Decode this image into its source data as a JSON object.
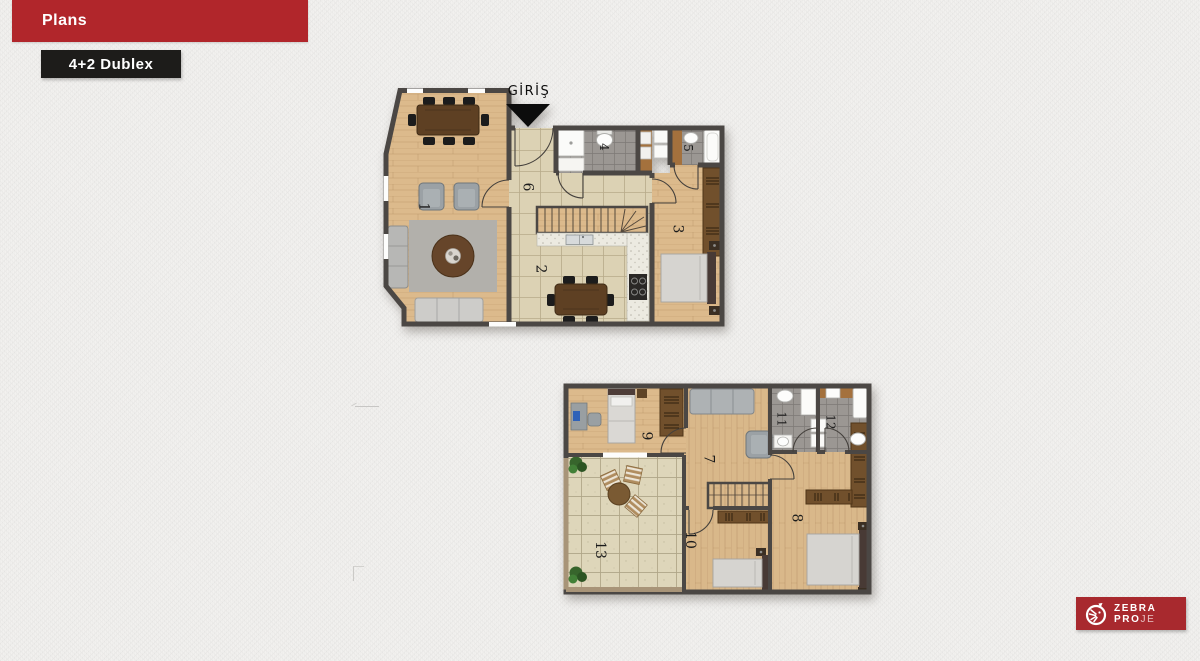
{
  "header": {
    "title": "Plans",
    "bar_color": "#b1262b"
  },
  "badge": {
    "label": "4+2 Dublex",
    "bg_color": "#1d1c1a"
  },
  "plans": {
    "upper": {
      "entrance_label": "GİRİŞ",
      "rooms": [
        {
          "number": "1"
        },
        {
          "number": "2"
        },
        {
          "number": "3"
        },
        {
          "number": "4"
        },
        {
          "number": "5"
        },
        {
          "number": "6"
        }
      ]
    },
    "lower": {
      "rooms": [
        {
          "number": "7"
        },
        {
          "number": "8"
        },
        {
          "number": "9"
        },
        {
          "number": "10"
        },
        {
          "number": "11"
        },
        {
          "number": "12"
        },
        {
          "number": "13"
        }
      ]
    }
  },
  "logo": {
    "line1": "ZEBRA",
    "line2_bold": "PRO",
    "line2_light": "JE",
    "bg_color": "#a8292e"
  },
  "palette": {
    "wall": "#4b4744",
    "wood_floor": "#dcba8c",
    "tile_floor": "#dcd2b4",
    "bath_tile": "#9b9793",
    "terrace_tile": "#ded6ba"
  }
}
